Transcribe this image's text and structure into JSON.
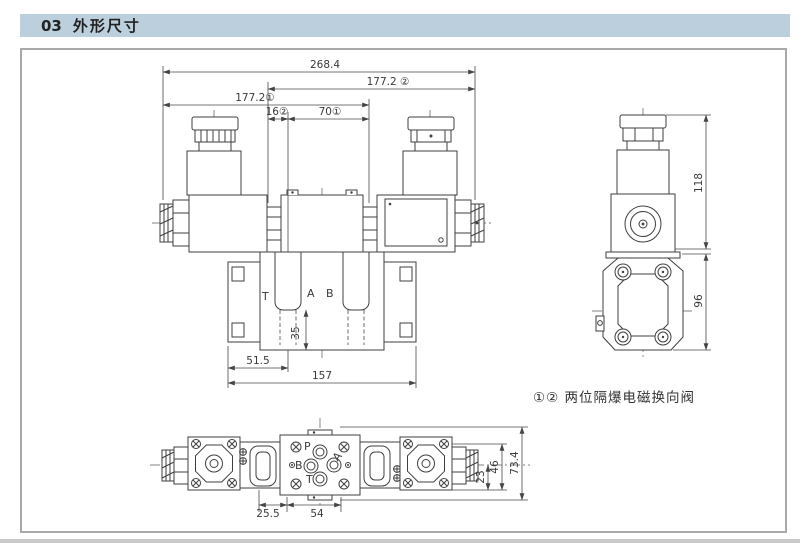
{
  "header": {
    "number": "03",
    "title": "外形尺寸"
  },
  "caption": {
    "text": "①② 两位隔爆电磁换向阀"
  },
  "front_view": {
    "dims": {
      "overall": "268.4",
      "upper_right": "177.2 ②",
      "upper_left": "177.2①",
      "center_small": "16②",
      "center_large": "70①",
      "port_vertical": "35",
      "subplate_left": "51.5",
      "subplate_total": "157"
    },
    "ports": {
      "t": "T",
      "a": "A",
      "b": "B"
    }
  },
  "side_view": {
    "dims": {
      "solenoid_height": "118",
      "body_height": "96"
    }
  },
  "top_view": {
    "dims": {
      "left_offset": "25.5",
      "port_span": "54",
      "half_height": "23",
      "inner_height": "46",
      "total_height": "73.4"
    },
    "ports": {
      "p": "P",
      "a": "A",
      "b": "B",
      "t": "T"
    }
  }
}
